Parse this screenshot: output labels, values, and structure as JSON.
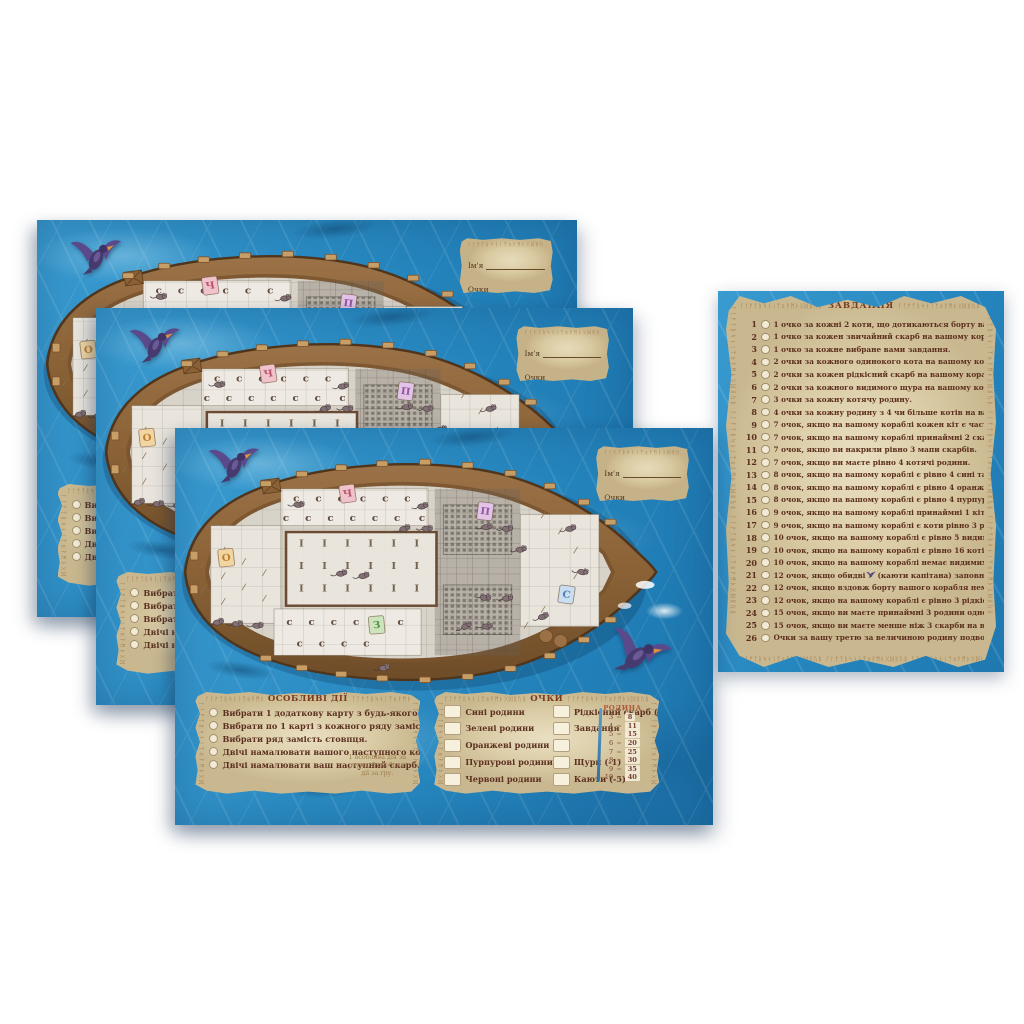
{
  "decor": {
    "runes": "ᚴᛚᚠᛏᚱᛋᚾᛁᛉᛟᚹᛗᚦᚷᛞᛝᚢᛒ"
  },
  "board": {
    "name_box": {
      "name_label": "Ім'я",
      "score_label": "Очки"
    },
    "special_actions": {
      "title": "ОСОБЛИВІ ДІЇ",
      "items": [
        "Вибрати 1 додаткову карту з будь-якого іншого стовпця.",
        "Вибрати по 1 карті з кожного ряду замість стовпця.",
        "Вибрати ряд замість стовпця.",
        "Двічі намалювати вашого наступного кота.",
        "Двічі намалювати ваш наступний скарб."
      ],
      "note": "1 особлива дія за раунд, 3 особливі дії за гру."
    },
    "points": {
      "title": "ОЧКИ",
      "family_rows": [
        "Сині родини",
        "Зелені родини",
        "Оранжеві родини",
        "Пурпурові родини",
        "Червоні родини"
      ],
      "bonus_rows": [
        "Рідкісний скарб (3)",
        "Завдання",
        "",
        "Щури (-1)",
        "Каюти (-5)"
      ],
      "family_table": {
        "title": "РОДИНА",
        "rows": [
          [
            "3",
            "8"
          ],
          [
            "4",
            "11"
          ],
          [
            "5",
            "15"
          ],
          [
            "6",
            "20"
          ],
          [
            "7",
            "25"
          ],
          [
            "8",
            "30"
          ],
          [
            "9",
            "35"
          ],
          [
            "10",
            "40"
          ]
        ]
      }
    },
    "ship": {
      "letter_tiles": [
        {
          "letter": "Ч",
          "bg": "#f0c3cc",
          "fg": "#b9536a",
          "x": 196,
          "y": 52,
          "r": -8
        },
        {
          "letter": "П",
          "bg": "#e3c4e6",
          "fg": "#9456a0",
          "x": 357,
          "y": 74,
          "r": 7
        },
        {
          "letter": "О",
          "bg": "#f2d6a2",
          "fg": "#c07e30",
          "x": 54,
          "y": 132,
          "r": -6
        },
        {
          "letter": "С",
          "bg": "#cadef0",
          "fg": "#4f7fb5",
          "x": 452,
          "y": 178,
          "r": 8
        },
        {
          "letter": "З",
          "bg": "#cde4bf",
          "fg": "#55913f",
          "x": 230,
          "y": 216,
          "r": -5
        }
      ],
      "crescents": [
        [
          136,
          62
        ],
        [
          162,
          62
        ],
        [
          188,
          62
        ],
        [
          214,
          62
        ],
        [
          240,
          62
        ],
        [
          266,
          62
        ],
        [
          124,
          86
        ],
        [
          150,
          86
        ],
        [
          176,
          86
        ],
        [
          202,
          86
        ],
        [
          228,
          86
        ],
        [
          254,
          86
        ],
        [
          283,
          86
        ],
        [
          128,
          216
        ],
        [
          154,
          216
        ],
        [
          180,
          216
        ],
        [
          206,
          216
        ],
        [
          232,
          216
        ],
        [
          258,
          216
        ],
        [
          140,
          243
        ],
        [
          166,
          243
        ],
        [
          192,
          243
        ],
        [
          218,
          243
        ]
      ],
      "bones": [
        [
          142,
          118
        ],
        [
          169,
          118
        ],
        [
          196,
          118
        ],
        [
          223,
          118
        ],
        [
          250,
          118
        ],
        [
          277,
          118
        ],
        [
          142,
          146
        ],
        [
          169,
          146
        ],
        [
          196,
          146
        ],
        [
          223,
          146
        ],
        [
          250,
          146
        ],
        [
          277,
          146
        ],
        [
          142,
          174
        ],
        [
          169,
          174
        ],
        [
          196,
          174
        ],
        [
          223,
          174
        ],
        [
          250,
          174
        ],
        [
          277,
          174
        ]
      ],
      "rats": [
        [
          138,
          66
        ],
        [
          283,
          68
        ],
        [
          262,
          96
        ],
        [
          288,
          96
        ],
        [
          358,
          94
        ],
        [
          382,
          96
        ],
        [
          398,
          122
        ],
        [
          188,
          152
        ],
        [
          214,
          155
        ],
        [
          356,
          182
        ],
        [
          382,
          183
        ],
        [
          334,
          218
        ],
        [
          358,
          218
        ],
        [
          44,
          213
        ],
        [
          66,
          215
        ],
        [
          90,
          217
        ],
        [
          238,
          270
        ],
        [
          456,
          96
        ],
        [
          424,
          206
        ],
        [
          470,
          150
        ]
      ],
      "feathers": [
        [
          26,
          112
        ],
        [
          26,
          144
        ],
        [
          26,
          176
        ],
        [
          50,
          126
        ],
        [
          50,
          158
        ],
        [
          50,
          190
        ],
        [
          74,
          140
        ],
        [
          74,
          172
        ],
        [
          98,
          154
        ],
        [
          98,
          186
        ],
        [
          404,
          62
        ],
        [
          424,
          82
        ],
        [
          444,
          102
        ],
        [
          462,
          126
        ],
        [
          462,
          158
        ],
        [
          444,
          180
        ],
        [
          424,
          200
        ],
        [
          404,
          220
        ]
      ]
    }
  },
  "tasks_card": {
    "title": "ЗАВДАННЯ",
    "tasks": [
      {
        "num": "1",
        "text": "1 очко за кожні 2 коти, що дотикаються борту вашого корабля."
      },
      {
        "num": "2",
        "text": "1 очко за кожен звичайний скарб на вашому кораблі."
      },
      {
        "num": "3",
        "text": "1 очко за кожне вибране вами завдання."
      },
      {
        "num": "4",
        "text": "2 очки за кожного одинокого кота на вашому кораблі."
      },
      {
        "num": "5",
        "text": "2 очки за кожен рідкісний скарб на вашому кораблі."
      },
      {
        "num": "6",
        "text": "2 очки за кожного видимого щура на вашому кораблі."
      },
      {
        "num": "7",
        "text": "3 очки за кожну котячу родину."
      },
      {
        "num": "8",
        "text": "4 очки за кожну родину з 4 чи більше котів на вашому кораблі."
      },
      {
        "num": "9",
        "text": "7 очок, якщо на вашому кораблі кожен кіт є частиною родини."
      },
      {
        "num": "10",
        "text": "7 очок, якщо на вашому кораблі принаймні 2 скарби дотикаються 1 щура."
      },
      {
        "num": "11",
        "text": "7 очок, якщо ви накрили рівно 3 мапи скарбів."
      },
      {
        "num": "12",
        "text": "7 очок, якщо ви маєте рівно 4 котячі родини."
      },
      {
        "num": "13",
        "text": "8 очок, якщо на вашому кораблі є рівно 4 сині та 4 зелені коти."
      },
      {
        "num": "14",
        "text": "8 очок, якщо на вашому кораблі є рівно 4 оранжеві та 4 пурпурові коти."
      },
      {
        "num": "15",
        "text": "8 очок, якщо на вашому кораблі є рівно 4 пурпурові та 4 червоні коти."
      },
      {
        "num": "16",
        "text": "9 очок, якщо на вашому кораблі принаймні 1 кіт дотикається рівно 5 скарбів."
      },
      {
        "num": "17",
        "text": "9 очок, якщо на вашому кораблі є коти рівно 3 різних кольорів."
      },
      {
        "num": "18",
        "text": "10 очок, якщо на вашому кораблі є рівно 5 видимих щурів."
      },
      {
        "num": "19",
        "text": "10 очок, якщо на вашому кораблі є рівно 16 котів."
      },
      {
        "num": "20",
        "text": "10 очок, якщо на вашому кораблі немає видимих щурів."
      },
      {
        "num": "21",
        "pre": "12 очок, якщо обидві",
        "post": "(каюти капітана) заповнені.",
        "bird": true
      },
      {
        "num": "22",
        "text": "12 очок, якщо вздовж борту вашого корабля немає вільних клітинок."
      },
      {
        "num": "23",
        "text": "12 очок, якщо на вашому кораблі є рівно 3 рідкісні та 6 звичайних скарбів."
      },
      {
        "num": "24",
        "text": "15 очок, якщо ви маєте принаймні 3 родини одного кольору."
      },
      {
        "num": "25",
        "text": "15 очок, якщо ви маєте менше ніж 3 скарби на вашому кораблі."
      },
      {
        "num": "26",
        "text": "Очки за вашу третю за величиною родину подвоюються."
      }
    ]
  }
}
